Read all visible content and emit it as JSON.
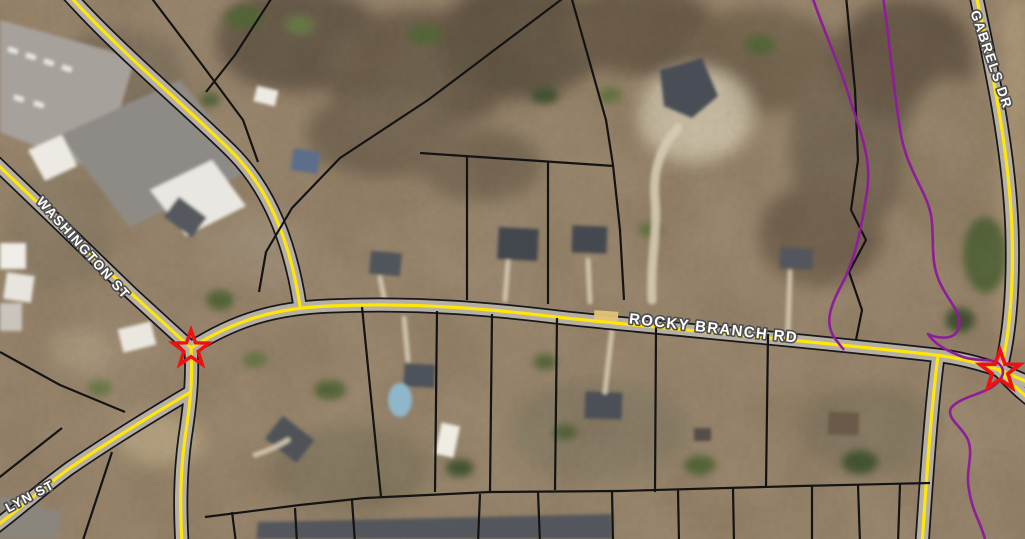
{
  "map": {
    "title": "Aerial parcel map with road and stream overlays",
    "road_labels": {
      "washington_st": "WASHINGTON ST",
      "rocky_branch_rd": "ROCKY BRANCH RD",
      "gabrels_dr": "GABRELS DR",
      "lyn_st": "LYN ST"
    },
    "markers": {
      "count": 2,
      "west_star": "west intersection star",
      "east_star": "east intersection star"
    },
    "colors": {
      "road_centerline": "#ffe608",
      "road_pavement": "#b5afa4",
      "road_casing": "#17171c",
      "parcel_line": "#141414",
      "stream_line": "#8e1d99",
      "star_outline": "#ee1111",
      "label_text": "#ffffff",
      "label_halo": "#4f4f4f",
      "highlight_segment": "#e2c478"
    }
  }
}
